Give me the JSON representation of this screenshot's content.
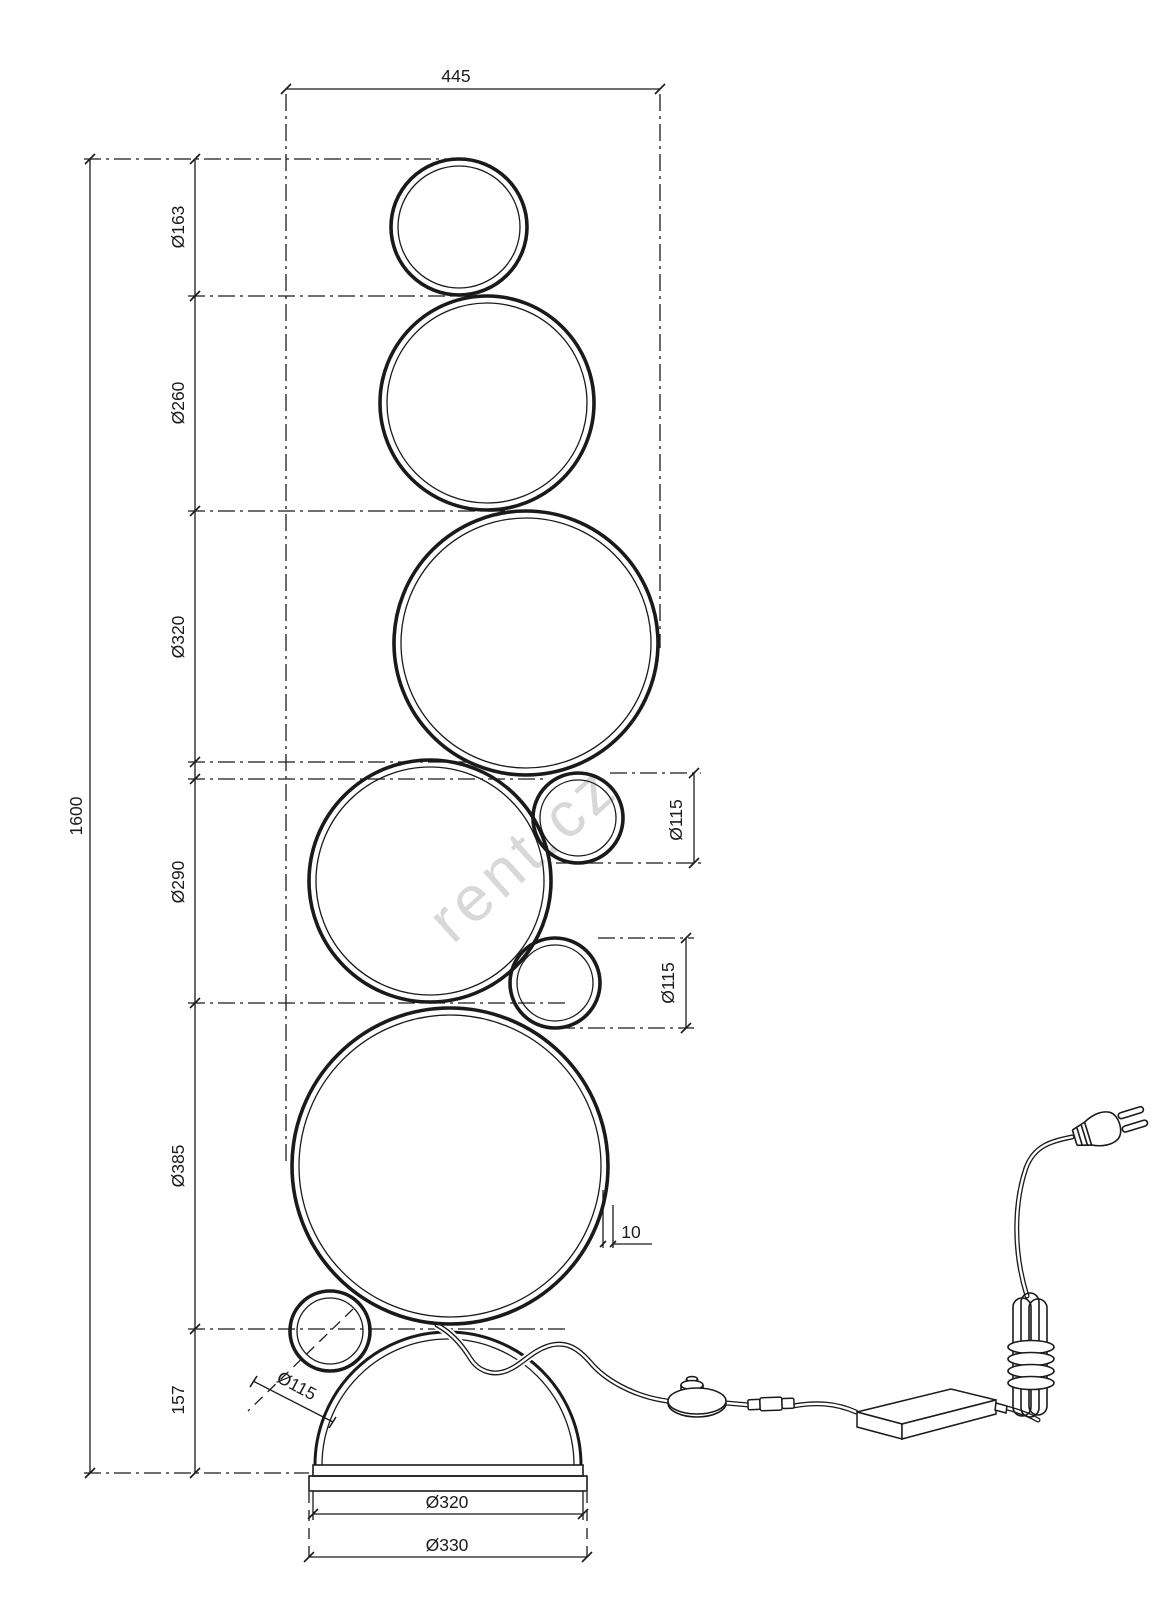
{
  "watermark": "rent.cz",
  "colors": {
    "line": "#1a1a1a",
    "text": "#1c1c1c",
    "watermark": "#d2d2d2",
    "background": "#ffffff"
  },
  "dimensions": {
    "overall_width": "445",
    "overall_height": "1600",
    "ring_top": "Ø163",
    "ring_2": "Ø260",
    "ring_3": "Ø320",
    "ring_4": "Ø290",
    "ring_5": "Ø385",
    "small_ring_right_upper": "Ø115",
    "small_ring_right_lower": "Ø115",
    "small_ring_bottom_left": "Ø115",
    "base_section_height": "157",
    "profile_thickness": "10",
    "base_plate_diameter": "Ø320",
    "base_foot_diameter": "Ø330"
  }
}
